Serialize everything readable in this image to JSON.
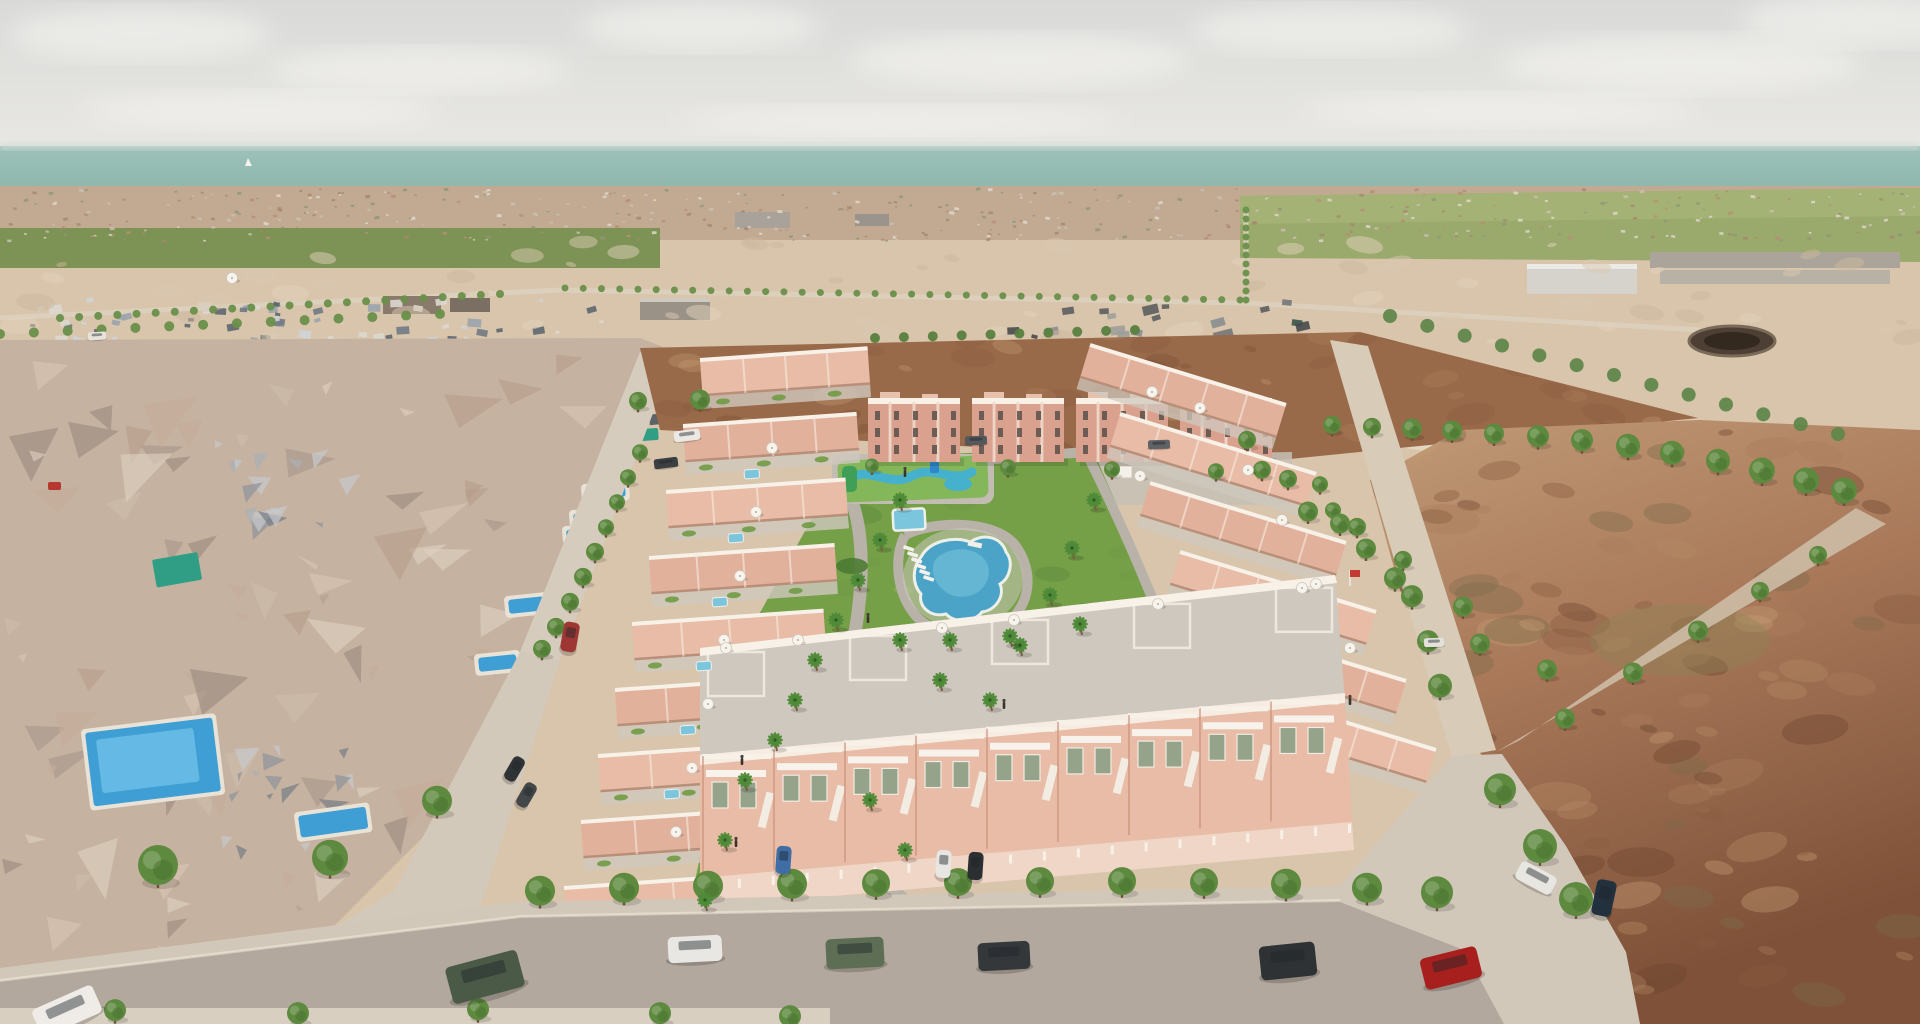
{
  "scene": {
    "type": "aerial-3d-architectural-render",
    "description": "Bird's-eye 3D visualization of a new salmon-pink townhouse development with communal lagoon pool, kids splash pool and palm gardens, set between low-poly photogrammetry housing on the left, empty desert plots on the right, a distant coastal town and the sea on the horizon.",
    "no_visible_text": true
  },
  "palette": {
    "sky_top": "#d9dad8",
    "sky_bottom": "#edebe7",
    "cloud": "#f7f6f3",
    "sea": "#9cc2ba",
    "sea_deep": "#8eb6ad",
    "haze": "#d5ddd6",
    "town_base": "#c2aa92",
    "orchard": "#7d9255",
    "field_green": "#9aa96c",
    "sand": "#d8c5ac",
    "sand_light": "#e4d6c0",
    "road_light": "#ddd2bf",
    "mesh_base": "#c6b2a0",
    "dirt": "#996a4a",
    "desert": "#a9795a",
    "desert_dark": "#7e5138",
    "salmon": "#e8bca6",
    "salmon_light": "#f3d9c9",
    "salmon_dark": "#d79e88",
    "white_trim": "#f8f1e8",
    "terrace_gray": "#cfc8be",
    "lawn": "#76a048",
    "path": "#b8b2a9",
    "pool": "#4ba3c8",
    "pool_light": "#7cc6dd",
    "kids_deck": "#84b65a",
    "kids_water": "#45b1cc",
    "tree": "#5d8a3e",
    "tree_dark": "#477030",
    "palm": "#4e8a38",
    "trunk": "#6b5138",
    "asphalt": "#b3a89e",
    "sidewalk": "#d2c8ba"
  },
  "objects": {
    "clouds": [
      [
        140,
        34,
        130,
        26
      ],
      [
        420,
        70,
        150,
        22
      ],
      [
        700,
        26,
        120,
        24
      ],
      [
        1020,
        60,
        170,
        26
      ],
      [
        1330,
        30,
        140,
        24
      ],
      [
        1680,
        64,
        180,
        28
      ],
      [
        1860,
        20,
        120,
        26
      ],
      [
        260,
        110,
        180,
        18
      ],
      [
        900,
        120,
        220,
        14
      ],
      [
        1500,
        110,
        200,
        16
      ]
    ],
    "boat": [
      248,
      166
    ],
    "textures": [
      {
        "name": "town-speckle",
        "region": [
          0,
          188,
          1920,
          52
        ],
        "count": 430,
        "colors": [
          "#b78f74",
          "#ded7cb",
          "#8e9877",
          "#a58a6e",
          "#c9c0b2"
        ],
        "smin": 2,
        "smax": 5,
        "shape": "rect",
        "opacity": 0.85,
        "seed": 11
      },
      {
        "name": "houses-band-1",
        "region": [
          0,
          298,
          640,
          50
        ],
        "count": 70,
        "colors": [
          "#cfd4d9",
          "#9aa3ad",
          "#707a84",
          "#dcd8d0",
          "#5d6670"
        ],
        "smin": 4,
        "smax": 14,
        "shape": "rect",
        "opacity": 0.9,
        "seed": 21
      },
      {
        "name": "houses-band-2",
        "region": [
          0,
          346,
          660,
          84
        ],
        "count": 80,
        "colors": [
          "#c7cdd4",
          "#8f99a4",
          "#626c77",
          "#d8d4cc",
          "#4f5660"
        ],
        "smin": 6,
        "smax": 20,
        "shape": "rect",
        "opacity": 0.9,
        "seed": 31
      },
      {
        "name": "white-blocks",
        "region": [
          0,
          352,
          260,
          78
        ],
        "count": 18,
        "colors": [
          "#e3e0da",
          "#cfd4d6",
          "#b9bec4"
        ],
        "smin": 10,
        "smax": 26,
        "shape": "rect",
        "opacity": 0.9,
        "seed": 41
      },
      {
        "name": "dark-cluster",
        "region": [
          1000,
          298,
          420,
          140
        ],
        "count": 70,
        "colors": [
          "#5c5e5f",
          "#737678",
          "#8b8e90",
          "#474a4c",
          "#9d9d99",
          "#3a544a"
        ],
        "smin": 6,
        "smax": 20,
        "shape": "rect",
        "opacity": 0.9,
        "seed": 51
      },
      {
        "name": "mesh-triangles",
        "clip": "clipMesh",
        "region": [
          0,
          340,
          700,
          684
        ],
        "count": 130,
        "colors": [
          "#d8c6b4",
          "#c4ad99",
          "#b59c88",
          "#a6968c",
          "#cfbeae",
          "#99897f",
          "#e0d2c2"
        ],
        "smin": 18,
        "smax": 64,
        "shape": "tri",
        "opacity": 0.6,
        "seed": 61
      },
      {
        "name": "mesh-gray-1",
        "region": [
          205,
          440,
          140,
          85
        ],
        "count": 16,
        "colors": [
          "#aab0b6",
          "#8d939b",
          "#c6c9cd",
          "#767d86"
        ],
        "smin": 10,
        "smax": 34,
        "shape": "tri",
        "opacity": 0.7,
        "seed": 71
      },
      {
        "name": "mesh-gray-2",
        "region": [
          215,
          745,
          155,
          100
        ],
        "count": 18,
        "colors": [
          "#aab0b6",
          "#8d939b",
          "#c6c9cd",
          "#767d86"
        ],
        "smin": 10,
        "smax": 34,
        "shape": "tri",
        "opacity": 0.7,
        "seed": 81
      },
      {
        "name": "dirt-mottle",
        "clip": "clipDirt",
        "region": [
          600,
          330,
          1100,
          140
        ],
        "count": 90,
        "colors": [
          "#8a5c3e",
          "#b07e58",
          "#c79a74",
          "#7a4e33"
        ],
        "smin": 10,
        "smax": 50,
        "shape": "blob",
        "opacity": 0.35,
        "seed": 91
      },
      {
        "name": "desert-mottle",
        "clip": "clipDesert",
        "region": [
          1300,
          420,
          620,
          604
        ],
        "count": 140,
        "colors": [
          "#8a5c40",
          "#a97e5c",
          "#c49a74",
          "#6f4730",
          "#b38a64",
          "#7d6b4a"
        ],
        "smin": 14,
        "smax": 70,
        "shape": "blob",
        "opacity": 0.4,
        "seed": 101
      },
      {
        "name": "sand-mottle",
        "region": [
          0,
          242,
          1920,
          100
        ],
        "count": 70,
        "colors": [
          "#e2d2bc",
          "#cbb79c",
          "#d9c8b0"
        ],
        "smin": 8,
        "smax": 40,
        "shape": "blob",
        "opacity": 0.5,
        "seed": 111
      },
      {
        "name": "lawn-mottle",
        "clip": "clipGarden",
        "region": [
          680,
          450,
          520,
          520
        ],
        "count": 45,
        "colors": [
          "#6d9844",
          "#8db257",
          "#5e8a3c"
        ],
        "smin": 10,
        "smax": 46,
        "shape": "blob",
        "opacity": 0.5,
        "seed": 121
      }
    ],
    "dot_rows": [
      {
        "x1": 60,
        "y1": 318,
        "x2": 500,
        "y2": 294,
        "n": 24,
        "r": 4,
        "color": "#6a8f4a"
      },
      {
        "x1": 565,
        "y1": 288,
        "x2": 1240,
        "y2": 300,
        "n": 38,
        "r": 3.5,
        "color": "#6a8f4a"
      },
      {
        "x1": 1246,
        "y1": 210,
        "x2": 1246,
        "y2": 300,
        "n": 11,
        "r": 3.5,
        "color": "#6a8f4a"
      },
      {
        "x1": 875,
        "y1": 338,
        "x2": 1135,
        "y2": 330,
        "n": 10,
        "r": 5,
        "color": "#587f3e"
      },
      {
        "x1": 1390,
        "y1": 316,
        "x2": 1838,
        "y2": 434,
        "n": 13,
        "r": 7,
        "color": "#61874b"
      },
      {
        "x1": 0,
        "y1": 334,
        "x2": 440,
        "y2": 314,
        "n": 14,
        "r": 5,
        "color": "#6a8f4a"
      }
    ],
    "street_trees": [
      [
        540,
        896,
        15
      ],
      [
        624,
        893,
        15
      ],
      [
        708,
        891,
        15
      ],
      [
        792,
        889,
        15
      ],
      [
        876,
        888,
        14
      ],
      [
        958,
        887,
        14
      ],
      [
        1040,
        886,
        14
      ],
      [
        1122,
        886,
        14
      ],
      [
        1204,
        887,
        14
      ],
      [
        1286,
        889,
        15
      ],
      [
        1367,
        893,
        15
      ],
      [
        1437,
        898,
        16
      ],
      [
        1500,
        795,
        16
      ],
      [
        1540,
        852,
        17
      ],
      [
        1576,
        905,
        17
      ],
      [
        1565,
        722,
        10
      ],
      [
        1633,
        676,
        10
      ],
      [
        1698,
        634,
        10
      ],
      [
        1760,
        594,
        9
      ],
      [
        1818,
        558,
        9
      ],
      [
        1320,
        487,
        8
      ],
      [
        1333,
        513,
        8
      ],
      [
        1357,
        530,
        9
      ],
      [
        1403,
        563,
        9
      ],
      [
        1463,
        610,
        10
      ],
      [
        1480,
        647,
        10
      ],
      [
        1547,
        673,
        10
      ],
      [
        1247,
        443,
        9
      ],
      [
        1262,
        473,
        9
      ],
      [
        1288,
        482,
        9
      ],
      [
        1308,
        515,
        10
      ],
      [
        1340,
        527,
        10
      ],
      [
        1366,
        552,
        10
      ],
      [
        1395,
        582,
        11
      ],
      [
        1412,
        600,
        11
      ],
      [
        1428,
        645,
        11
      ],
      [
        1440,
        690,
        12
      ],
      [
        638,
        404,
        9
      ],
      [
        700,
        403,
        10
      ],
      [
        640,
        455,
        8
      ],
      [
        628,
        480,
        8
      ],
      [
        617,
        505,
        8
      ],
      [
        606,
        530,
        8
      ],
      [
        595,
        555,
        9
      ],
      [
        583,
        580,
        9
      ],
      [
        570,
        605,
        9
      ],
      [
        556,
        630,
        9
      ],
      [
        542,
        652,
        9
      ],
      [
        115,
        1014,
        11
      ],
      [
        298,
        1017,
        11
      ],
      [
        478,
        1013,
        11
      ],
      [
        660,
        1017,
        11
      ],
      [
        790,
        1020,
        11
      ],
      [
        158,
        872,
        20
      ],
      [
        330,
        864,
        18
      ],
      [
        437,
        806,
        15
      ],
      [
        1008,
        470,
        8
      ],
      [
        1112,
        472,
        8
      ],
      [
        1216,
        474,
        8
      ],
      [
        872,
        468,
        7
      ],
      [
        1332,
        428,
        9
      ],
      [
        1372,
        430,
        9
      ],
      [
        1412,
        432,
        10
      ],
      [
        1452,
        434,
        10
      ],
      [
        1494,
        437,
        10
      ],
      [
        1538,
        440,
        11
      ],
      [
        1582,
        444,
        11
      ],
      [
        1628,
        450,
        12
      ],
      [
        1672,
        457,
        12
      ],
      [
        1718,
        465,
        12
      ],
      [
        1762,
        475,
        13
      ],
      [
        1806,
        485,
        13
      ],
      [
        1844,
        495,
        13
      ]
    ],
    "palms": [
      [
        900,
        500
      ],
      [
        880,
        540
      ],
      [
        858,
        580
      ],
      [
        836,
        620
      ],
      [
        815,
        660
      ],
      [
        795,
        700
      ],
      [
        775,
        740
      ],
      [
        900,
        640
      ],
      [
        940,
        680
      ],
      [
        990,
        700
      ],
      [
        1020,
        645
      ],
      [
        1050,
        595
      ],
      [
        1072,
        548
      ],
      [
        1094,
        500
      ],
      [
        950,
        640
      ],
      [
        1010,
        636
      ],
      [
        1080,
        624
      ],
      [
        745,
        780
      ],
      [
        725,
        840
      ],
      [
        705,
        900
      ],
      [
        870,
        800
      ],
      [
        905,
        850
      ]
    ],
    "umbrellas": [
      [
        772,
        448
      ],
      [
        756,
        512
      ],
      [
        740,
        576
      ],
      [
        724,
        640
      ],
      [
        708,
        704
      ],
      [
        692,
        768
      ],
      [
        676,
        832
      ],
      [
        726,
        648
      ],
      [
        798,
        640
      ],
      [
        942,
        628
      ],
      [
        1014,
        620
      ],
      [
        1158,
        604
      ],
      [
        1302,
        588
      ],
      [
        1152,
        392
      ],
      [
        1200,
        408
      ],
      [
        1248,
        470
      ],
      [
        1282,
        520
      ],
      [
        1316,
        584
      ],
      [
        1350,
        648
      ],
      [
        1140,
        476
      ],
      [
        232,
        278
      ]
    ],
    "terrace_pools": [
      [
        744,
        470
      ],
      [
        728,
        534
      ],
      [
        712,
        598
      ],
      [
        696,
        662
      ],
      [
        680,
        726
      ],
      [
        664,
        790
      ]
    ],
    "mesh_pools": [
      {
        "x": 85,
        "y": 733,
        "w": 128,
        "h": 74,
        "rot": -7,
        "big": true
      },
      {
        "x": 585,
        "y": 488,
        "w": 40,
        "h": 12,
        "rot": -5
      },
      {
        "x": 573,
        "y": 514,
        "w": 34,
        "h": 12,
        "rot": -5
      },
      {
        "x": 566,
        "y": 530,
        "w": 30,
        "h": 10,
        "rot": -5
      },
      {
        "x": 508,
        "y": 600,
        "w": 36,
        "h": 14,
        "rot": -6
      },
      {
        "x": 478,
        "y": 658,
        "w": 38,
        "h": 14,
        "rot": -6
      },
      {
        "x": 298,
        "y": 816,
        "w": 68,
        "h": 22,
        "rot": -8
      }
    ],
    "tarps": [
      {
        "x": 152,
        "y": 560,
        "w": 46,
        "h": 28,
        "rot": -10,
        "c": "#2f9e85"
      },
      {
        "x": 628,
        "y": 430,
        "w": 30,
        "h": 12,
        "rot": -4,
        "c": "#2f9e85"
      },
      {
        "x": 48,
        "y": 482,
        "w": 13,
        "h": 8,
        "rot": 0,
        "c": "#b5372f"
      }
    ],
    "loungers": [
      [
        904,
        545
      ],
      [
        908,
        551
      ],
      [
        912,
        557
      ],
      [
        916,
        563
      ],
      [
        920,
        569
      ],
      [
        924,
        575
      ]
    ],
    "figures": [
      [
        868,
        616
      ],
      [
        736,
        840
      ],
      [
        1004,
        702
      ],
      [
        742,
        758
      ],
      [
        1350,
        698
      ],
      [
        905,
        470
      ]
    ],
    "cars": [
      {
        "x": 668,
        "y": 936,
        "w": 54,
        "h": 26,
        "rot": -3,
        "c": "#e9e7e3"
      },
      {
        "x": 826,
        "y": 938,
        "w": 58,
        "h": 30,
        "rot": -3,
        "c": "#5d6e54"
      },
      {
        "x": 978,
        "y": 942,
        "w": 52,
        "h": 28,
        "rot": -3,
        "c": "#35383b"
      },
      {
        "x": 448,
        "y": 958,
        "w": 74,
        "h": 38,
        "rot": -15,
        "c": "#4a5a47"
      },
      {
        "x": 34,
        "y": 996,
        "w": 66,
        "h": 30,
        "rot": -24,
        "c": "#efece7"
      },
      {
        "x": 1260,
        "y": 944,
        "w": 56,
        "h": 34,
        "rot": -6,
        "c": "#2f3234"
      },
      {
        "x": 1422,
        "y": 952,
        "w": 58,
        "h": 32,
        "rot": -14,
        "c": "#a8201d"
      },
      {
        "x": 1594,
        "y": 880,
        "w": 20,
        "h": 36,
        "rot": 12,
        "c": "#23303e"
      },
      {
        "x": 1516,
        "y": 868,
        "w": 40,
        "h": 20,
        "rot": 28,
        "c": "#e8e6e1"
      },
      {
        "x": 776,
        "y": 846,
        "w": 15,
        "h": 28,
        "rot": 4,
        "c": "#3f6da5"
      },
      {
        "x": 936,
        "y": 850,
        "w": 15,
        "h": 28,
        "rot": 4,
        "c": "#e8e6e2"
      },
      {
        "x": 968,
        "y": 852,
        "w": 15,
        "h": 28,
        "rot": 4,
        "c": "#2c2f31"
      },
      {
        "x": 674,
        "y": 430,
        "w": 26,
        "h": 11,
        "rot": -7,
        "c": "#ece9e4"
      },
      {
        "x": 654,
        "y": 458,
        "w": 24,
        "h": 10,
        "rot": -7,
        "c": "#3c3f42"
      },
      {
        "x": 562,
        "y": 622,
        "w": 16,
        "h": 30,
        "rot": 10,
        "c": "#9e3734"
      },
      {
        "x": 508,
        "y": 756,
        "w": 13,
        "h": 26,
        "rot": 30,
        "c": "#303336"
      },
      {
        "x": 520,
        "y": 782,
        "w": 13,
        "h": 26,
        "rot": 30,
        "c": "#44474a"
      },
      {
        "x": 88,
        "y": 332,
        "w": 18,
        "h": 8,
        "rot": -4,
        "c": "#e6e3dd"
      },
      {
        "x": 965,
        "y": 436,
        "w": 22,
        "h": 9,
        "rot": -2,
        "c": "#55585b"
      },
      {
        "x": 1148,
        "y": 440,
        "w": 22,
        "h": 9,
        "rot": -2,
        "c": "#606366"
      },
      {
        "x": 1424,
        "y": 638,
        "w": 20,
        "h": 9,
        "rot": -2,
        "c": "#e4e1db"
      }
    ],
    "apartments": {
      "x0": 868,
      "dx": 104,
      "n": 4,
      "y": 402,
      "w": 92,
      "h": 60
    },
    "left_rows": {
      "n": 9,
      "x0": 700,
      "y0": 360,
      "dx": -17,
      "dy": 66,
      "w": 168,
      "h": 36,
      "rot": -4
    },
    "right_rows": {
      "n": 6,
      "x0": 1090,
      "y0": 345,
      "dx": 30,
      "dy": 69,
      "len": 205,
      "h": 34,
      "rot": 17
    },
    "front_units": {
      "n": 9,
      "x0": 702,
      "dx": 71,
      "facade_y": 762,
      "slope": -0.096,
      "terrace_slope": -0.113
    },
    "flag": {
      "x": 1350,
      "y": 570,
      "c": "#c33a34"
    }
  }
}
